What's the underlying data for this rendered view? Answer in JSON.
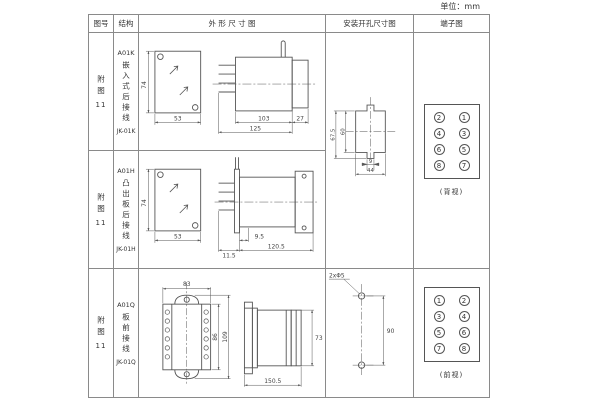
{
  "page": {
    "unit_label": "单位：mm"
  },
  "header": {
    "fig": "图号",
    "structure": "结构",
    "outline": "外 形 尺 寸 图",
    "install": "安装开孔尺寸图",
    "terminal": "端子图"
  },
  "rows": [
    {
      "fig": "附图",
      "fig_num": "11",
      "model": "A01K",
      "structure_vertical": "嵌入式后接线",
      "code": "JK-01K",
      "dims": {
        "front_h": "74",
        "front_w": "53",
        "d1": "103",
        "d2": "27",
        "d3": "125"
      }
    },
    {
      "fig": "附图",
      "fig_num": "11",
      "model": "A01H",
      "structure_vertical": "凸出板后接线",
      "code": "JK-01H",
      "dims": {
        "front_h": "74",
        "front_w": "53",
        "d1": "9.5",
        "d2": "120.5",
        "d3": "11.5"
      }
    },
    {
      "fig": "附图",
      "fig_num": "11",
      "model": "A01Q",
      "structure_vertical": "板前接线",
      "code": "JK-01Q",
      "dims": {
        "front_w": "83",
        "front_h_inner": "86",
        "front_h_outer": "109",
        "side_w": "150.5",
        "side_h": "73"
      }
    }
  ],
  "install_cutout": {
    "outer_h": "67.5",
    "inner_h": "60",
    "notch_w": "9",
    "width": "44"
  },
  "install_holes": {
    "spacing": "90",
    "hole_label": "2xΦ5"
  },
  "terminal_rear": {
    "cells": [
      "2",
      "1",
      "4",
      "3",
      "6",
      "5",
      "8",
      "7"
    ],
    "caption": "(背视)"
  },
  "terminal_front": {
    "cells": [
      "1",
      "2",
      "3",
      "4",
      "5",
      "6",
      "7",
      "8"
    ],
    "caption": "(前视)"
  }
}
